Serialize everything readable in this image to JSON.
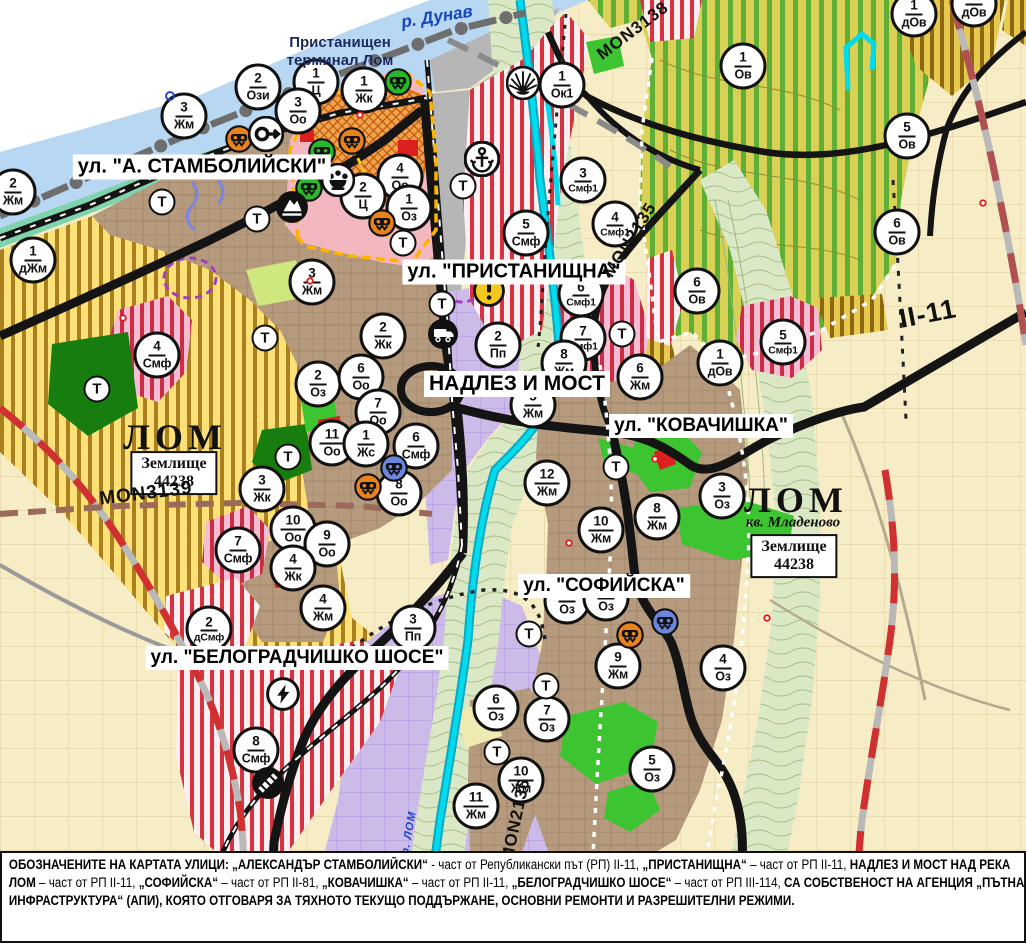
{
  "map": {
    "annotations": {
      "river": "р. Дунав",
      "terminal_line1": "Пристанищен",
      "terminal_line2": "терминал Лом",
      "city_left": "ЛОМ",
      "city_right": "ЛОМ",
      "district_right": "кв. Младеново",
      "land_line1": "Землище",
      "land_line2": "44238"
    },
    "street_labels": [
      {
        "name": "street-label-stamboliyski",
        "text": "ул. \"А. СТАМБОЛИЙСКИ\"",
        "x": 202,
        "y": 167,
        "fs": 20
      },
      {
        "name": "street-label-pristanishtna",
        "text": "ул. \"ПРИСТАНИЩНА\"",
        "x": 514,
        "y": 272,
        "fs": 20
      },
      {
        "name": "street-label-nadlez-i-most",
        "text": "НАДЛЕЗ И МОСТ",
        "x": 517,
        "y": 384,
        "fs": 21
      },
      {
        "name": "street-label-kovachishka",
        "text": "ул. \"КОВАЧИШКА\"",
        "x": 701,
        "y": 426,
        "fs": 19
      },
      {
        "name": "street-label-sofiyska",
        "text": "ул. \"СОФИЙСКА\"",
        "x": 604,
        "y": 586,
        "fs": 19
      },
      {
        "name": "street-label-belogradchishko-shose",
        "text": "ул. \"БЕЛОГРАДЧИШКО ШОСЕ\"",
        "x": 297,
        "y": 658,
        "fs": 19
      }
    ],
    "road_labels": [
      {
        "text": "MON3138",
        "x": 633,
        "y": 31,
        "rot": -37,
        "fs": 17
      },
      {
        "text": "MON2135",
        "x": 630,
        "y": 240,
        "rot": -58,
        "fs": 17
      },
      {
        "text": "MON3139",
        "x": 146,
        "y": 494,
        "rot": -7,
        "fs": 19
      },
      {
        "text": "MON2136",
        "x": 516,
        "y": 820,
        "rot": -78,
        "fs": 17
      },
      {
        "text": "II-11",
        "x": 928,
        "y": 314,
        "rot": -11,
        "fs": 27
      },
      {
        "text": "р. ЛОМ",
        "x": 409,
        "y": 833,
        "rot": -80,
        "fs": 11,
        "color": "#1545c0"
      }
    ],
    "t_label": "Т",
    "t_markers": [
      [
        162,
        202
      ],
      [
        257,
        219
      ],
      [
        265,
        338
      ],
      [
        97,
        389
      ],
      [
        403,
        243
      ],
      [
        463,
        186
      ],
      [
        442,
        304
      ],
      [
        622,
        334
      ],
      [
        288,
        457
      ],
      [
        616,
        467
      ],
      [
        529,
        634
      ],
      [
        546,
        686
      ],
      [
        497,
        752
      ]
    ],
    "zone_markers": [
      {
        "n": "2",
        "c": "Ози",
        "x": 258,
        "y": 87
      },
      {
        "n": "1",
        "c": "Ц",
        "x": 316,
        "y": 82
      },
      {
        "n": "1",
        "c": "Жк",
        "x": 364,
        "y": 90
      },
      {
        "n": "3",
        "c": "Оо",
        "x": 298,
        "y": 111
      },
      {
        "n": "3",
        "c": "Жм",
        "x": 184,
        "y": 116
      },
      {
        "n": "2",
        "c": "Жм",
        "x": 13,
        "y": 192
      },
      {
        "n": "1",
        "c": "дЖм",
        "x": 33,
        "y": 260
      },
      {
        "n": "3",
        "c": "Жм",
        "x": 312,
        "y": 282
      },
      {
        "n": "4",
        "c": "Оо",
        "x": 400,
        "y": 177
      },
      {
        "n": "2",
        "c": "Ц",
        "x": 363,
        "y": 196
      },
      {
        "n": "1",
        "c": "Оз",
        "x": 409,
        "y": 208
      },
      {
        "n": "1",
        "c": "Ок1",
        "x": 562,
        "y": 85
      },
      {
        "n": "3",
        "c": "Смф1",
        "x": 583,
        "y": 180
      },
      {
        "n": "4",
        "c": "Смф1",
        "x": 615,
        "y": 224
      },
      {
        "n": "5",
        "c": "Смф",
        "x": 526,
        "y": 233
      },
      {
        "n": "6",
        "c": "Смф1",
        "x": 581,
        "y": 294
      },
      {
        "n": "7",
        "c": "Смф1",
        "x": 583,
        "y": 338
      },
      {
        "n": "2",
        "c": "Пп",
        "x": 498,
        "y": 345
      },
      {
        "n": "8",
        "c": "Жм",
        "x": 564,
        "y": 363
      },
      {
        "n": "5",
        "c": "Жм",
        "x": 533,
        "y": 405
      },
      {
        "n": "2",
        "c": "Жк",
        "x": 383,
        "y": 336
      },
      {
        "n": "4",
        "c": "Смф",
        "x": 157,
        "y": 355
      },
      {
        "n": "2",
        "c": "Оз",
        "x": 318,
        "y": 384
      },
      {
        "n": "6",
        "c": "Оо",
        "x": 361,
        "y": 377
      },
      {
        "n": "7",
        "c": "Оо",
        "x": 378,
        "y": 412
      },
      {
        "n": "11",
        "c": "Оо",
        "x": 332,
        "y": 443
      },
      {
        "n": "1",
        "c": "Жс",
        "x": 366,
        "y": 444
      },
      {
        "n": "6",
        "c": "Смф",
        "x": 416,
        "y": 446
      },
      {
        "n": "8",
        "c": "Оо",
        "x": 399,
        "y": 493
      },
      {
        "n": "3",
        "c": "Жк",
        "x": 262,
        "y": 489
      },
      {
        "n": "10",
        "c": "Оо",
        "x": 293,
        "y": 529
      },
      {
        "n": "9",
        "c": "Оо",
        "x": 327,
        "y": 544
      },
      {
        "n": "7",
        "c": "Смф",
        "x": 238,
        "y": 550
      },
      {
        "n": "4",
        "c": "Жк",
        "x": 293,
        "y": 568
      },
      {
        "n": "2",
        "c": "дСмф",
        "x": 209,
        "y": 629
      },
      {
        "n": "4",
        "c": "Жм",
        "x": 323,
        "y": 608
      },
      {
        "n": "3",
        "c": "Пп",
        "x": 413,
        "y": 628
      },
      {
        "n": "8",
        "c": "Смф",
        "x": 256,
        "y": 750
      },
      {
        "n": "6",
        "c": "Ов",
        "x": 697,
        "y": 291
      },
      {
        "n": "6",
        "c": "Ов",
        "x": 897,
        "y": 232
      },
      {
        "n": "1",
        "c": "Ов",
        "x": 743,
        "y": 66
      },
      {
        "n": "5",
        "c": "Ов",
        "x": 907,
        "y": 136
      },
      {
        "n": "1",
        "c": "дОв",
        "x": 914,
        "y": 14
      },
      {
        "n": "1",
        "c": "дОв",
        "x": 974,
        "y": 4
      },
      {
        "n": "1",
        "c": "дОв",
        "x": 720,
        "y": 363
      },
      {
        "n": "5",
        "c": "Смф1",
        "x": 783,
        "y": 342
      },
      {
        "n": "6",
        "c": "Жм",
        "x": 640,
        "y": 377
      },
      {
        "n": "12",
        "c": "Жм",
        "x": 547,
        "y": 483
      },
      {
        "n": "10",
        "c": "Жм",
        "x": 601,
        "y": 530
      },
      {
        "n": "8",
        "c": "Жм",
        "x": 657,
        "y": 517
      },
      {
        "n": "3",
        "c": "Оз",
        "x": 722,
        "y": 496
      },
      {
        "n": "9",
        "c": "Жм",
        "x": 618,
        "y": 666
      },
      {
        "n": "4",
        "c": "Оз",
        "x": 723,
        "y": 668
      },
      {
        "n": "6",
        "c": "Оз",
        "x": 496,
        "y": 708
      },
      {
        "n": "7",
        "c": "Оз",
        "x": 547,
        "y": 719
      },
      {
        "n": "5",
        "c": "Оз",
        "x": 652,
        "y": 769
      },
      {
        "n": "10",
        "c": "Жм",
        "x": 521,
        "y": 780
      },
      {
        "n": "11",
        "c": "Жм",
        "x": 476,
        "y": 806
      },
      {
        "n": "8",
        "c": "Оз",
        "x": 567,
        "y": 601
      },
      {
        "n": "5",
        "c": "Оз",
        "x": 606,
        "y": 598
      }
    ],
    "icons": [
      {
        "type": "masks",
        "color": "#2ab82a",
        "x": 398,
        "y": 82
      },
      {
        "type": "masks",
        "color": "#2ab82a",
        "x": 322,
        "y": 152
      },
      {
        "type": "masks",
        "color": "#2ab82a",
        "x": 309,
        "y": 188
      },
      {
        "type": "masks",
        "color": "#e8821e",
        "x": 239,
        "y": 139
      },
      {
        "type": "masks",
        "color": "#e8821e",
        "x": 352,
        "y": 141
      },
      {
        "type": "masks",
        "color": "#e8821e",
        "x": 382,
        "y": 223
      },
      {
        "type": "masks",
        "color": "#e8821e",
        "x": 368,
        "y": 487
      },
      {
        "type": "masks",
        "color": "#e8821e",
        "x": 630,
        "y": 635
      },
      {
        "type": "masks",
        "color": "#6c86dc",
        "x": 394,
        "y": 468
      },
      {
        "type": "masks",
        "color": "#6c86dc",
        "x": 665,
        "y": 622
      },
      {
        "type": "key",
        "x": 266,
        "y": 134,
        "size": 36
      },
      {
        "type": "crown",
        "x": 338,
        "y": 180,
        "size": 34
      },
      {
        "type": "mountain",
        "x": 292,
        "y": 207,
        "size": 34
      },
      {
        "type": "anchor",
        "x": 482,
        "y": 159,
        "size": 36
      },
      {
        "type": "sun-rays",
        "x": 523,
        "y": 83,
        "size": 34
      },
      {
        "type": "warning",
        "x": 489,
        "y": 291,
        "size": 32
      },
      {
        "type": "bus",
        "x": 443,
        "y": 334,
        "size": 32
      },
      {
        "type": "lightning",
        "x": 283,
        "y": 694,
        "size": 34
      },
      {
        "type": "railway-crossing",
        "x": 268,
        "y": 783,
        "size": 34
      },
      {
        "type": "blue-ring",
        "x": 170,
        "y": 96,
        "size": 18
      },
      {
        "type": "red-point",
        "x": 360,
        "y": 115,
        "size": 16
      },
      {
        "type": "red-point",
        "x": 310,
        "y": 281,
        "size": 16
      },
      {
        "type": "red-point",
        "x": 123,
        "y": 318,
        "size": 16
      },
      {
        "type": "red-point",
        "x": 655,
        "y": 459,
        "size": 16
      },
      {
        "type": "red-point",
        "x": 569,
        "y": 543,
        "size": 16
      },
      {
        "type": "red-point",
        "x": 767,
        "y": 618,
        "size": 16
      },
      {
        "type": "red-point",
        "x": 983,
        "y": 203,
        "size": 16
      }
    ],
    "legend_colors": {
      "residential_brown": "#b59a7d",
      "agricultural_yellow_stripe": "#fbe178",
      "orchard_olive_stripe": "#d8d155",
      "production_purple": "#ccbae9",
      "mixed_function_red_stripe": "#d63340",
      "park_green": "#3cc431",
      "port_gray": "#b6b6b6",
      "river_blue": "#b7d7f3",
      "valley_green": "#dbe8c6",
      "center_pink": "#f3b7bf",
      "center_orange_hatch": "#f2a352",
      "farmland_cream": "#f6ecc6",
      "lom_river_cyan": "#00dbee"
    }
  },
  "footer": {
    "segments": [
      {
        "t": "ОБОЗНАЧЕНИТЕ НА КАРТАТА УЛИЦИ: „АЛЕКСАНДЪР СТАМБОЛИЙСКИ“",
        "b": 1
      },
      {
        "t": " - част от Републикански път (РП) II-11, ",
        "b": 0
      },
      {
        "t": "„ПРИСТАНИЩНА“",
        "b": 1
      },
      {
        "t": " – част от РП II-11, ",
        "b": 0
      },
      {
        "t": "НАДЛЕЗ И МОСТ НАД РЕКА ЛОМ",
        "b": 1
      },
      {
        "t": " – част от РП II-11, ",
        "b": 0
      },
      {
        "t": "„СОФИЙСКА“",
        "b": 1
      },
      {
        "t": " – част от РП II-81, ",
        "b": 0
      },
      {
        "t": "„КОВАЧИШКА“",
        "b": 1
      },
      {
        "t": " – част от РП II-11, ",
        "b": 0
      },
      {
        "t": "„БЕЛОГРАДЧИШКО ШОСЕ“",
        "b": 1
      },
      {
        "t": " – част от РП III-114, ",
        "b": 0
      },
      {
        "t": "СА СОБСТВЕНОСТ НА АГЕНЦИЯ „ПЪТНА ИНФРАСТРУКТУРА“ (АПИ), КОЯТО ОТГОВАРЯ ЗА ТЯХНОТО ТЕКУЩО ПОДДЪРЖАНЕ, ОСНОВНИ РЕМОНТИ И РАЗРЕШИТЕЛНИ РЕЖИМИ.",
        "b": 1
      }
    ]
  }
}
